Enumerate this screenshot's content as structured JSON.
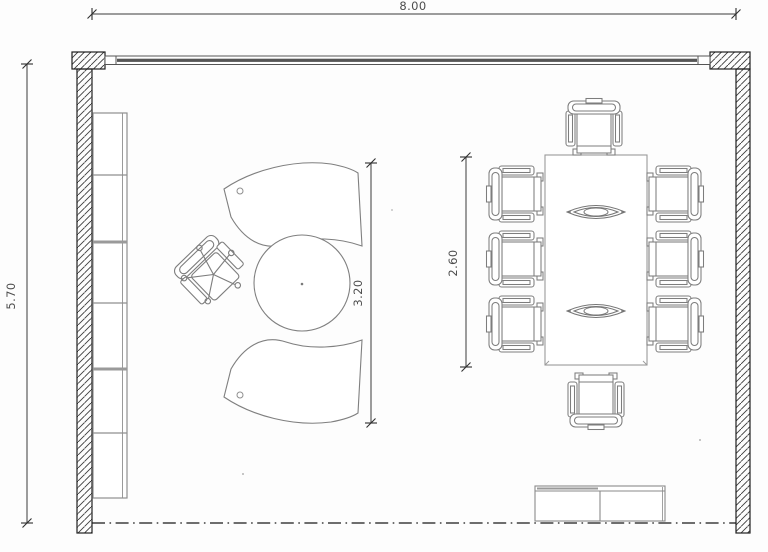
{
  "drawing": {
    "name": "office-meeting-room-floor-plan",
    "labels": {
      "room_width": "8.00",
      "room_depth": "5.70",
      "desk_span": "3.20",
      "table_span": "2.60"
    },
    "furniture": {
      "shelf_compartments": 6,
      "conference_chairs": 8,
      "table_centerpieces": 2,
      "items": [
        "wall-shelf-unit",
        "curved-executive-desk-with-round-extension",
        "executive-swivel-chair",
        "conference-table",
        "sideboard-cabinet"
      ]
    },
    "colors": {
      "background": "#fdfdfd",
      "walls": "#1f1f1f",
      "furniture_lines": "#7f7f7f",
      "dimension_lines": "#3a3a3a",
      "window_band": "#565656"
    }
  }
}
